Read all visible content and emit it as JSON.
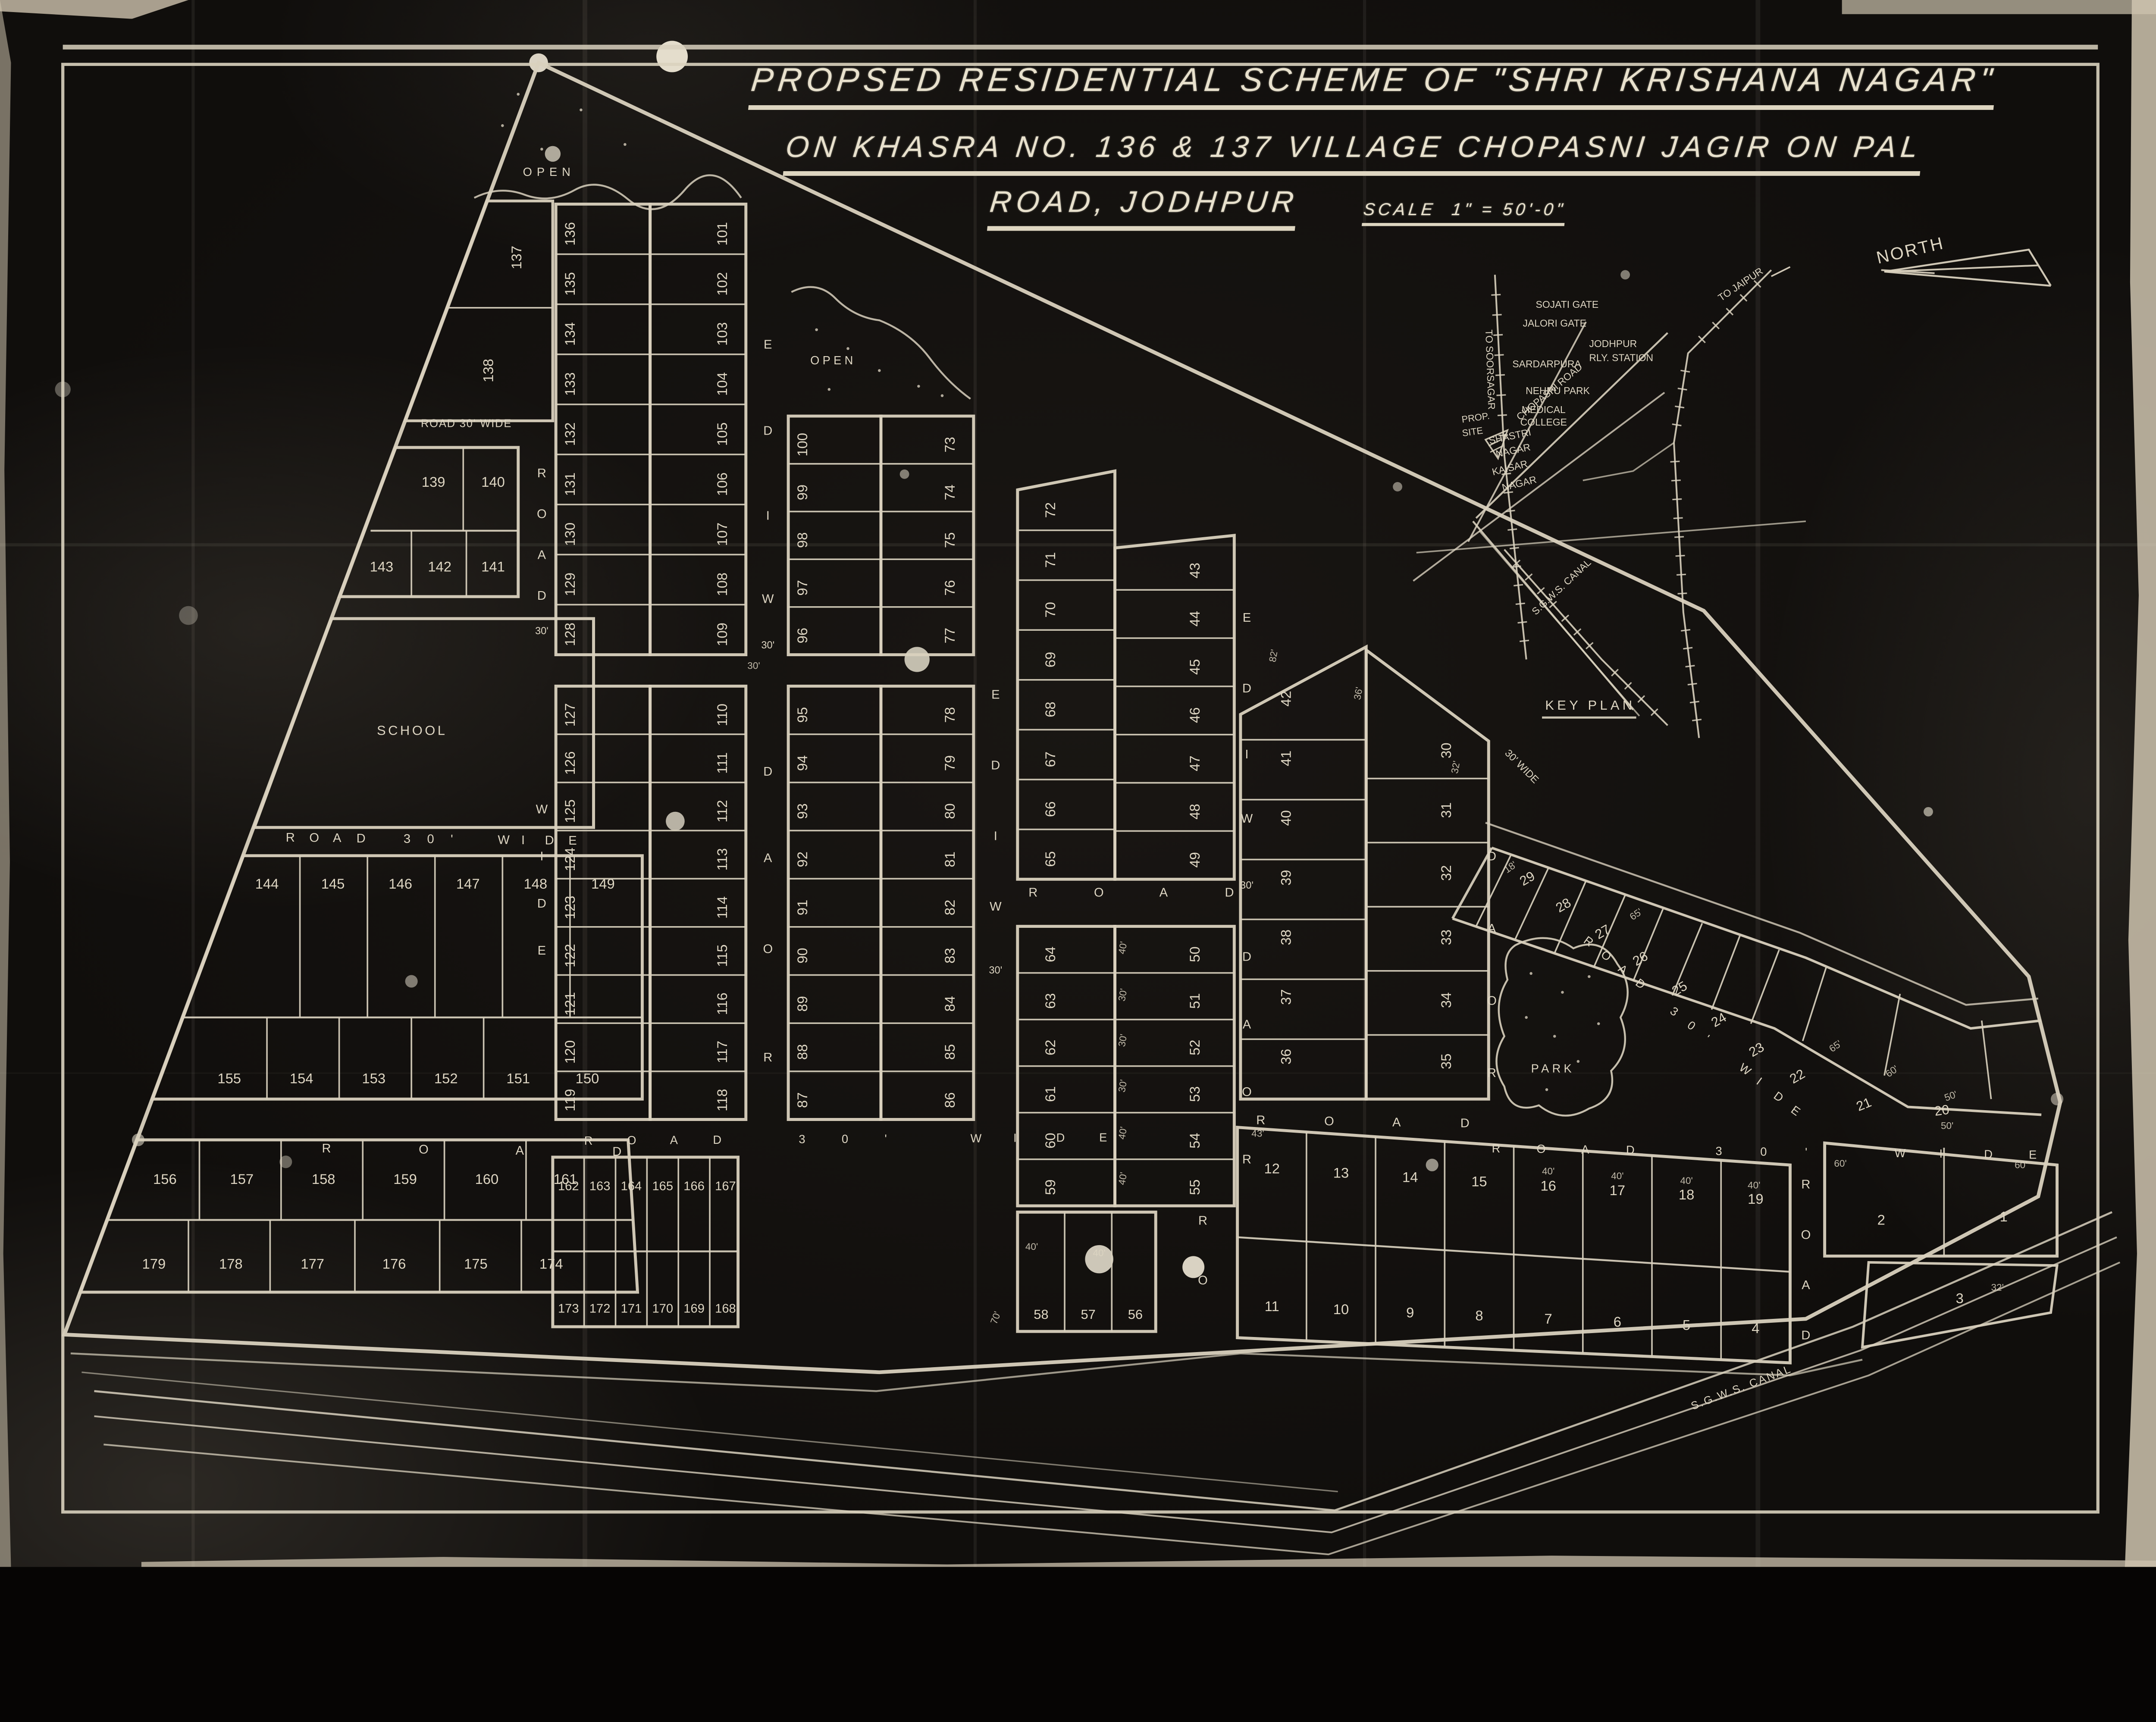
{
  "title": {
    "line1": "PROPSED RESIDENTIAL SCHEME OF \"SHRI KRISHANA NAGAR\"",
    "line2": "ON KHASRA NO. 136 & 137 VILLAGE CHOPASNI JAGIR ON PAL",
    "line3": "ROAD, JODHPUR",
    "scale_label": "SCALE",
    "scale_value": "1\" = 50'-0\""
  },
  "north": {
    "label": "NORTH"
  },
  "key_plan": {
    "heading": "KEY PLAN",
    "labels": [
      {
        "id": "soorsagar",
        "text": "TO SOORSAGAR"
      },
      {
        "id": "jaipur",
        "text": "TO JAIPUR"
      },
      {
        "id": "sojati",
        "text": "SOJATI GATE"
      },
      {
        "id": "jalori",
        "text": "JALORI GATE"
      },
      {
        "id": "rly1",
        "text": "JODHPUR"
      },
      {
        "id": "rly2",
        "text": "RLY. STATION"
      },
      {
        "id": "chopasni",
        "text": "CHOPASNI ROAD"
      },
      {
        "id": "sardarpura",
        "text": "SARDARPURA"
      },
      {
        "id": "nehru",
        "text": "NEHRU PARK"
      },
      {
        "id": "medical1",
        "text": "MEDICAL"
      },
      {
        "id": "medical2",
        "text": "COLLEGE"
      },
      {
        "id": "shastri1",
        "text": "SHASTRI"
      },
      {
        "id": "shastri2",
        "text": "NAGAR"
      },
      {
        "id": "prop1",
        "text": "PROP."
      },
      {
        "id": "prop2",
        "text": "SITE"
      },
      {
        "id": "kaisar1",
        "text": "KAISAR"
      },
      {
        "id": "kaisar2",
        "text": "NAGAR"
      },
      {
        "id": "canalkp",
        "text": "S.G.W.S. CANAL"
      }
    ]
  },
  "areas": {
    "open1": "OPEN",
    "open2": "OPEN",
    "school": "SCHOOL",
    "park": "PARK"
  },
  "canal_label": "S.G.W.S. CANAL",
  "road_labels": {
    "h1": "ROAD 30' WIDE",
    "h2": "ROAD 30' WIDE",
    "h3": "ROAD",
    "h4": "ROAD 30' WIDE",
    "h5": "ROAD",
    "h6": "ROAD",
    "h7": "ROAD 30' WIDE",
    "h8": "ROAD 30' WIDE",
    "road_word": "ROAD",
    "wide_word": "WIDE",
    "marker30": "30'",
    "marker30wide": "30' WIDE"
  },
  "blocks": {
    "sliver": [
      "137",
      "138"
    ],
    "b139r1": [
      "139",
      "140"
    ],
    "b139r2": [
      "143",
      "142",
      "141"
    ],
    "b144r1": [
      "144",
      "145",
      "146",
      "147",
      "148",
      "149"
    ],
    "b144r2": [
      "155",
      "154",
      "153",
      "152",
      "151",
      "150"
    ],
    "b156r1": [
      "156",
      "157",
      "158",
      "159",
      "160",
      "161"
    ],
    "b156r2": [
      "179",
      "178",
      "177",
      "176",
      "175",
      "174"
    ],
    "b162r1": [
      "162",
      "163",
      "164",
      "165",
      "166",
      "167"
    ],
    "b162r2": [
      "173",
      "172",
      "171",
      "170",
      "169",
      "168"
    ],
    "b56": [
      "58",
      "57",
      "56"
    ],
    "A1L": [
      "136",
      "135",
      "134",
      "133",
      "132",
      "131",
      "130",
      "129",
      "128"
    ],
    "A1R": [
      "101",
      "102",
      "103",
      "104",
      "105",
      "106",
      "107",
      "108",
      "109"
    ],
    "A2L": [
      "127",
      "126",
      "125",
      "124",
      "123",
      "122",
      "121",
      "120",
      "119"
    ],
    "A2R": [
      "110",
      "111",
      "112",
      "113",
      "114",
      "115",
      "116",
      "117",
      "118"
    ],
    "B1L": [
      "100",
      "99",
      "98",
      "97",
      "96"
    ],
    "B1R": [
      "73",
      "74",
      "75",
      "76",
      "77"
    ],
    "B2L": [
      "95",
      "94",
      "93",
      "92",
      "91",
      "90",
      "89",
      "88",
      "87"
    ],
    "B2R": [
      "78",
      "79",
      "80",
      "81",
      "82",
      "83",
      "84",
      "85",
      "86"
    ],
    "CUL": [
      "72",
      "71",
      "70",
      "69",
      "68",
      "67",
      "66",
      "65"
    ],
    "CUR": [
      "43",
      "44",
      "45",
      "46",
      "47",
      "48",
      "49"
    ],
    "CLL": [
      "64",
      "63",
      "62",
      "61",
      "60",
      "59"
    ],
    "CLR": [
      "50",
      "51",
      "52",
      "53",
      "54",
      "55"
    ],
    "DL": [
      "42",
      "41",
      "40",
      "39",
      "38",
      "37",
      "36"
    ],
    "DR": [
      "30",
      "31",
      "32",
      "33",
      "34",
      "35"
    ],
    "E1": [
      "12",
      "13",
      "14",
      "15",
      "16",
      "17",
      "18",
      "19"
    ],
    "E2": [
      "11",
      "10",
      "9",
      "8",
      "7",
      "6",
      "5",
      "4"
    ],
    "F1": [
      "2",
      "1"
    ],
    "F2": [
      "3"
    ],
    "strip": [
      "29",
      "28",
      "27",
      "26",
      "25",
      "24",
      "23",
      "22",
      "21",
      "20"
    ]
  },
  "dims": [
    {
      "id": "d1",
      "text": "82'"
    },
    {
      "id": "d2",
      "text": "36'"
    },
    {
      "id": "d3",
      "text": "32'"
    },
    {
      "id": "d4",
      "text": "40'"
    },
    {
      "id": "d5",
      "text": "30'"
    },
    {
      "id": "d6",
      "text": "30'"
    },
    {
      "id": "d7",
      "text": "30'"
    },
    {
      "id": "d8",
      "text": "40'"
    },
    {
      "id": "d9",
      "text": "40'"
    },
    {
      "id": "d10",
      "text": "43'"
    },
    {
      "id": "d11",
      "text": "40'"
    },
    {
      "id": "d12",
      "text": "40'"
    },
    {
      "id": "d13",
      "text": "40'"
    },
    {
      "id": "d14",
      "text": "40'"
    },
    {
      "id": "d15",
      "text": "60'"
    },
    {
      "id": "d16",
      "text": "60'"
    },
    {
      "id": "d17",
      "text": "50'"
    },
    {
      "id": "d18",
      "text": "32'"
    },
    {
      "id": "d19",
      "text": "18'"
    },
    {
      "id": "d20",
      "text": "65'"
    },
    {
      "id": "d21",
      "text": "65'"
    },
    {
      "id": "d22",
      "text": "60'"
    },
    {
      "id": "d23",
      "text": "50'"
    },
    {
      "id": "d24",
      "text": "70'"
    },
    {
      "id": "d25",
      "text": "40'"
    },
    {
      "id": "d26",
      "text": "40'"
    },
    {
      "id": "d27",
      "text": "30'"
    }
  ]
}
